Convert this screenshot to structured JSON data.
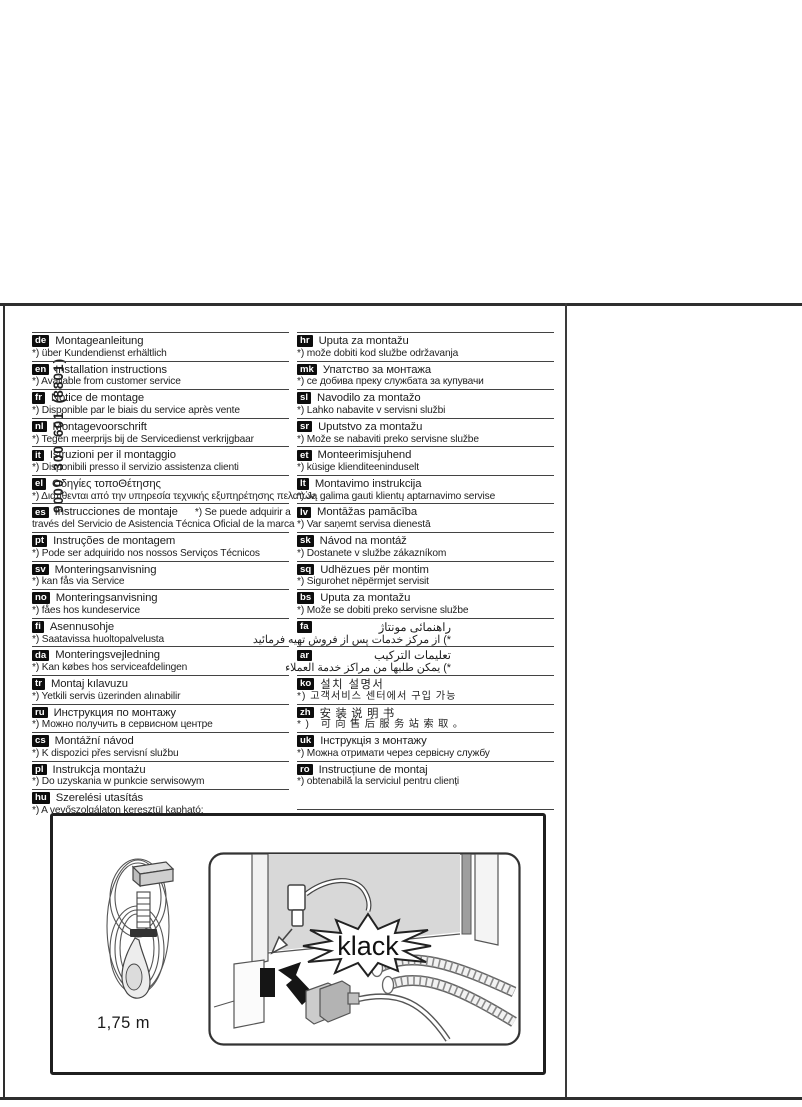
{
  "document": {
    "part_number": "9000 300 601 (8801)"
  },
  "languages": {
    "left": [
      {
        "code": "de",
        "title": "Montageanleitung",
        "note": "*) über Kundendienst erhältlich"
      },
      {
        "code": "en",
        "title": "Installation instructions",
        "note": "*) Available from customer service"
      },
      {
        "code": "fr",
        "title": "Notice de montage",
        "note": "*) Disponible par le biais du service après vente"
      },
      {
        "code": "nl",
        "title": "Montagevoorschrift",
        "note": "*) Tegen meerprijs bij de Servicedienst verkrijgbaar"
      },
      {
        "code": "it",
        "title": "Istruzioni per il montaggio",
        "note": "*) Disponibili presso il servizio assistenza clienti"
      },
      {
        "code": "el",
        "title": "Οδηγίες τοποΘέτησης",
        "note": "*) Διατίθενται από την υπηρεσία τεχνικής εξυπηρέτησης πελατών"
      },
      {
        "code": "es",
        "title": "Instrucciones de montaje",
        "title_suffix": "*) Se puede adquirir a",
        "note": "través del Servicio de Asistencia Técnica Oficial de la marca"
      },
      {
        "code": "pt",
        "title": "Instruções de montagem",
        "note": "*) Pode ser adquirido nos nossos Serviços Técnicos"
      },
      {
        "code": "sv",
        "title": "Monteringsanvisning",
        "note": "*) kan fås via Service"
      },
      {
        "code": "no",
        "title": "Monteringsanvisning",
        "note": "*) fåes hos kundeservice"
      },
      {
        "code": "fi",
        "title": "Asennusohje",
        "note": "*) Saatavissa huoltopalvelusta"
      },
      {
        "code": "da",
        "title": "Monteringsvejledning",
        "note": "*) Kan købes hos serviceafdelingen"
      },
      {
        "code": "tr",
        "title": "Montaj kılavuzu",
        "note": "*) Yetkili servis üzerinden alınabilir"
      },
      {
        "code": "ru",
        "title": "Инструкция по монтажу",
        "note": "*) Можно получить в сервисном центре"
      },
      {
        "code": "cs",
        "title": "Montážní návod",
        "note": "*) K dispozici přes servisní službu"
      },
      {
        "code": "pl",
        "title": "Instrukcja montażu",
        "note": "*) Do uzyskania w punkcie serwisowym"
      },
      {
        "code": "hu",
        "title": "Szerelési utasítás",
        "note": "*) A vevőszolgálaton keresztül kapható:"
      }
    ],
    "right": [
      {
        "code": "hr",
        "title": "Uputa za montažu",
        "note": "*) može dobiti kod službe održavanja"
      },
      {
        "code": "mk",
        "title": "Упатство за монтажа",
        "note": "*) се добива преку службата за купувачи"
      },
      {
        "code": "sl",
        "title": "Navodilo za montažo",
        "note": "*) Lahko nabavite v servisni službi"
      },
      {
        "code": "sr",
        "title": "Uputstvo za montažu",
        "note": "*) Može se nabaviti preko servisne službe"
      },
      {
        "code": "et",
        "title": "Monteerimisjuhend",
        "note": "*) küsige klienditeeninduselt"
      },
      {
        "code": "lt",
        "title": "Montavimo instrukcija",
        "note": "*) Ją galima gauti klientų aptarnavimo servise"
      },
      {
        "code": "lv",
        "title": "Montāžas pamācība",
        "note": "*) Var saņemt servisa dienestā"
      },
      {
        "code": "sk",
        "title": "Návod na montáž",
        "note": "*) Dostanete v službe zákazníkom"
      },
      {
        "code": "sq",
        "title": "Udhëzues për montim",
        "note": "*) Sigurohet nëpërmjet servisit"
      },
      {
        "code": "bs",
        "title": "Uputa za montažu",
        "note": "*) Može se dobiti preko servisne službe"
      },
      {
        "code": "fa",
        "dir": "rtl",
        "title": "راهنمائی مونتاژ",
        "note": "*) از مرکز خدمات پس از فروش تهیه فرمائید"
      },
      {
        "code": "ar",
        "dir": "rtl",
        "title": "تعليمات التركيب",
        "note": "*) يمكن طلبها من مراكز خدمة العملاء"
      },
      {
        "code": "ko",
        "title": "설치 설명서",
        "note": "*) 고객서비스 센터에서 구입 가능"
      },
      {
        "code": "zh",
        "title": "安装说明书",
        "note": "*) 可向售后服务站索取。"
      },
      {
        "code": "uk",
        "title": "Інструкція з монтажу",
        "note": "*) Можна отримати через сервісну службу"
      },
      {
        "code": "ro",
        "title": "Instrucțiune de montaj",
        "note": "*) obtenabilă la serviciul pentru clienți"
      }
    ]
  },
  "figure": {
    "cord_length_label": "1,75 m",
    "sound_label": "klack"
  }
}
